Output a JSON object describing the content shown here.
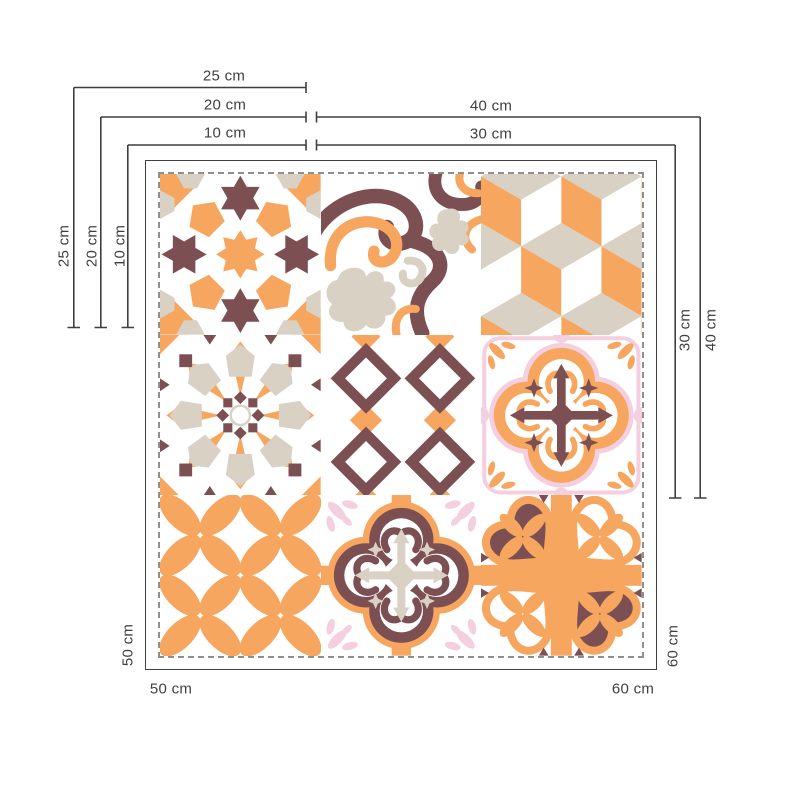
{
  "diagram": {
    "labels": {
      "top_w25": "25 cm",
      "top_w20": "20 cm",
      "top_w10": "10 cm",
      "top_w40": "40 cm",
      "top_w30": "30 cm",
      "left_h25": "25 cm",
      "left_h20": "20 cm",
      "left_h10": "10 cm",
      "right_h30": "30 cm",
      "right_h40": "40 cm",
      "bottom_left_v": "50 cm",
      "bottom_left_h": "50 cm",
      "bottom_right_v": "60 cm",
      "bottom_right_h": "60 cm"
    },
    "colors": {
      "orange": "#F6A65F",
      "maroon": "#7C4F53",
      "beige": "#D8D1C4",
      "pink": "#F3CFDF",
      "dimension_line": "#3F3F3F",
      "dashed_border": "#8F8F8F",
      "background": "#FFFFFF"
    },
    "tiles": [
      "moroccan-star-tile",
      "scroll-ornament-tile",
      "isometric-cubes-tile",
      "radial-star-tile",
      "diamond-lattice-tile",
      "orange-quatrefoil-tile",
      "circle-petals-tile",
      "maroon-quatrefoil-tile",
      "hearts-pinwheel-tile"
    ]
  }
}
